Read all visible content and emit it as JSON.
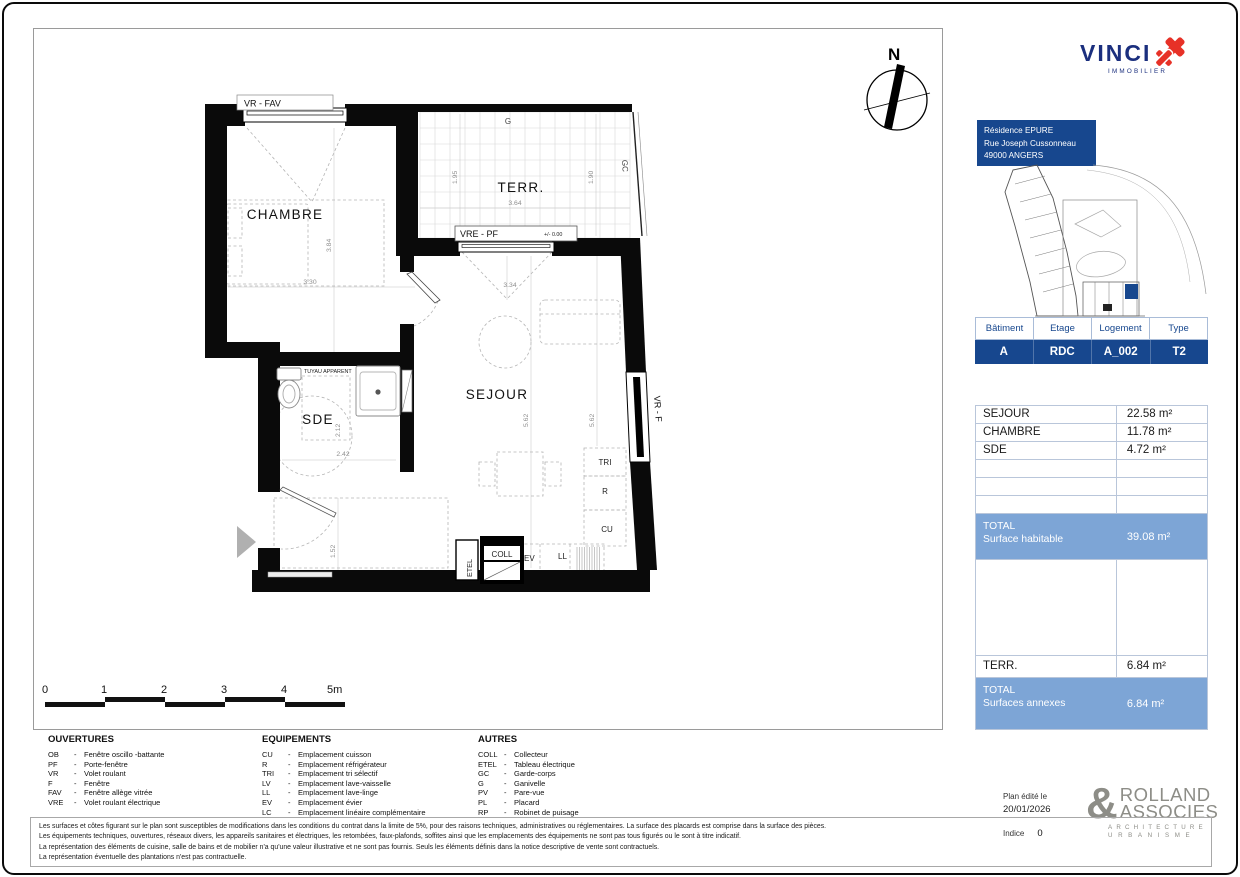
{
  "colors": {
    "navy": "#17478e",
    "steel": "#7da5d6",
    "red": "#e73127",
    "logo_gray": "#8d8d87"
  },
  "vinci": {
    "name": "VINCI",
    "subtitle": "IMMOBILIER"
  },
  "address": {
    "line1": "Résidence EPURE",
    "line2": "Rue Joseph Cussonneau",
    "line3": "49000 ANGERS"
  },
  "unit": {
    "headers": [
      "Bâtiment",
      "Etage",
      "Logement",
      "Type"
    ],
    "values": [
      "A",
      "RDC",
      "A_002",
      "T2"
    ]
  },
  "surfaces": {
    "rows": [
      {
        "label": "SEJOUR",
        "value": "22.58 m²"
      },
      {
        "label": "CHAMBRE",
        "value": "11.78 m²"
      },
      {
        "label": "SDE",
        "value": "4.72 m²"
      },
      {
        "label": "",
        "value": ""
      },
      {
        "label": "",
        "value": ""
      },
      {
        "label": "",
        "value": ""
      }
    ],
    "total_habitable": {
      "title": "TOTAL",
      "subtitle": "Surface habitable",
      "value": "39.08 m²"
    },
    "annex_row": {
      "label": "TERR.",
      "value": "6.84 m²"
    },
    "total_annexes": {
      "title": "TOTAL",
      "subtitle": "Surfaces annexes",
      "value": "6.84 m²"
    }
  },
  "plan": {
    "rooms": {
      "chambre": "CHAMBRE",
      "terrasse": "TERR.",
      "sejour": "SEJOUR",
      "sde": "SDE"
    },
    "openings": {
      "vr_fav": "VR - FAV",
      "vre_pf": "VRE - PF",
      "vr_f": "VR - F"
    },
    "level": "+/- 0.00",
    "notes": {
      "tuyau": "TUYAU APPARENT",
      "g": "G",
      "gc": "GC"
    },
    "equip": {
      "tri": "TRI",
      "r": "R",
      "cu": "CU",
      "coll": "COLL",
      "etel": "ETEL",
      "ev": "EV",
      "ll": "LL"
    },
    "dims": {
      "d330": "3.30",
      "d384": "3.84",
      "d195": "1.95",
      "d190": "1.90",
      "d364": "3.64",
      "d334": "3.34",
      "d562a": "5.62",
      "d562b": "5.62",
      "d212": "2.12",
      "d242": "2.42",
      "d152": "1.52"
    },
    "compass_n": "N"
  },
  "scalebar": {
    "t0": "0",
    "t1": "1",
    "t2": "2",
    "t3": "3",
    "t4": "4",
    "t5": "5m"
  },
  "legend": {
    "sep": "-",
    "col1": {
      "title": "OUVERTURES",
      "items": [
        {
          "code": "OB",
          "label": "Fenêtre oscillo -battante"
        },
        {
          "code": "PF",
          "label": "Porte-fenêtre"
        },
        {
          "code": "VR",
          "label": "Volet roulant"
        },
        {
          "code": "F",
          "label": "Fenêtre"
        },
        {
          "code": "FAV",
          "label": "Fenêtre allège vitrée"
        },
        {
          "code": "VRE",
          "label": "Volet roulant électrique"
        }
      ]
    },
    "col2": {
      "title": "EQUIPEMENTS",
      "items": [
        {
          "code": "CU",
          "label": "Emplacement cuisson"
        },
        {
          "code": "R",
          "label": "Emplacement réfrigérateur"
        },
        {
          "code": "TRI",
          "label": "Emplacement tri sélectif"
        },
        {
          "code": "LV",
          "label": "Emplacement lave-vaisselle"
        },
        {
          "code": "LL",
          "label": "Emplacement lave-linge"
        },
        {
          "code": "EV",
          "label": "Emplacement évier"
        },
        {
          "code": "LC",
          "label": "Emplacement linéaire complémentaire"
        }
      ]
    },
    "col3": {
      "title": "AUTRES",
      "items": [
        {
          "code": "COLL",
          "label": "Collecteur"
        },
        {
          "code": "ETEL",
          "label": "Tableau électrique"
        },
        {
          "code": "GC",
          "label": "Garde-corps"
        },
        {
          "code": "G",
          "label": "Ganivelle"
        },
        {
          "code": "PV",
          "label": "Pare-vue"
        },
        {
          "code": "PL",
          "label": "Placard"
        },
        {
          "code": "RP",
          "label": "Robinet de puisage"
        }
      ]
    }
  },
  "disclaimer": {
    "lines": [
      "Les surfaces et côtes figurant sur le plan sont susceptibles de modifications dans les conditions du contrat dans la limite de 5%, pour des raisons techniques, administratives ou réglementaires. La surface des placards est comprise dans la surface des pièces.",
      "Les équipements techniques, ouvertures, réseaux divers, les appareils sanitaires et électriques, les retombées, faux-plafonds, soffites ainsi que les emplacements des équipements ne sont pas tous figurés ou le sont à titre indicatif.",
      "La représentation des éléments de cuisine, salle de bains et de mobilier n'a qu'une valeur illustrative et ne sont pas fournis. Seuls les éléments définis dans la notice descriptive de vente sont contractuels.",
      "La représentation éventuelle des plantations n'est pas contractuelle."
    ]
  },
  "edition": {
    "label": "Plan édité le",
    "date": "20/01/2026",
    "indice_label": "Indice",
    "indice_value": "0"
  },
  "architect": {
    "amp": "&",
    "line1": "ROLLAND",
    "line2": "ASSOCIES",
    "sub1": "ARCHITECTURE",
    "sub2": "URBANISME"
  }
}
